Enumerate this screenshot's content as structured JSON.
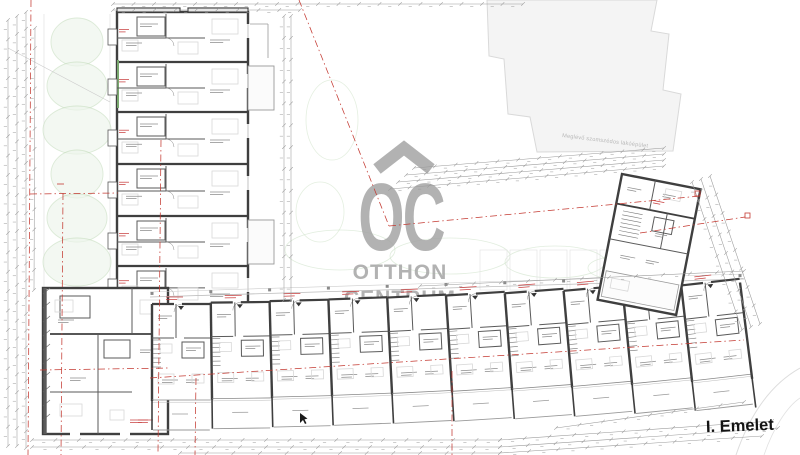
{
  "watermark": {
    "logo_text": "OC",
    "line1": "OTTHON",
    "line2": "CENTRUM"
  },
  "annotations": {
    "floor_label": "I. Emelet",
    "neighbor_building_label": "Meglévő szomszédos lakóépület"
  },
  "colors": {
    "paper": "#ffffff",
    "wall": "#3f3f3f",
    "wall_thin": "#5a5a5a",
    "dimension": "#9a9a9a",
    "micro_text": "#8c8c8c",
    "micro_red": "#c84040",
    "boundary_red": "#c43a32",
    "greenery": "#c9dfc2",
    "greenery_fill": "#eef5ec",
    "green_wall": "#7aa86f",
    "neighbor_fill": "#f4f4f4",
    "neighbor_stroke": "#d9d9d9",
    "furniture": "#d8d8d8",
    "rail": "#9a9a9a",
    "watermark": "#a5a5a5",
    "label_ink": "#141414"
  },
  "plan": {
    "left_wing": {
      "units": 6
    },
    "bottom_wing": {
      "units": 10
    },
    "right_wing": {
      "units": 1
    },
    "corner_block": {
      "units": 1
    }
  }
}
